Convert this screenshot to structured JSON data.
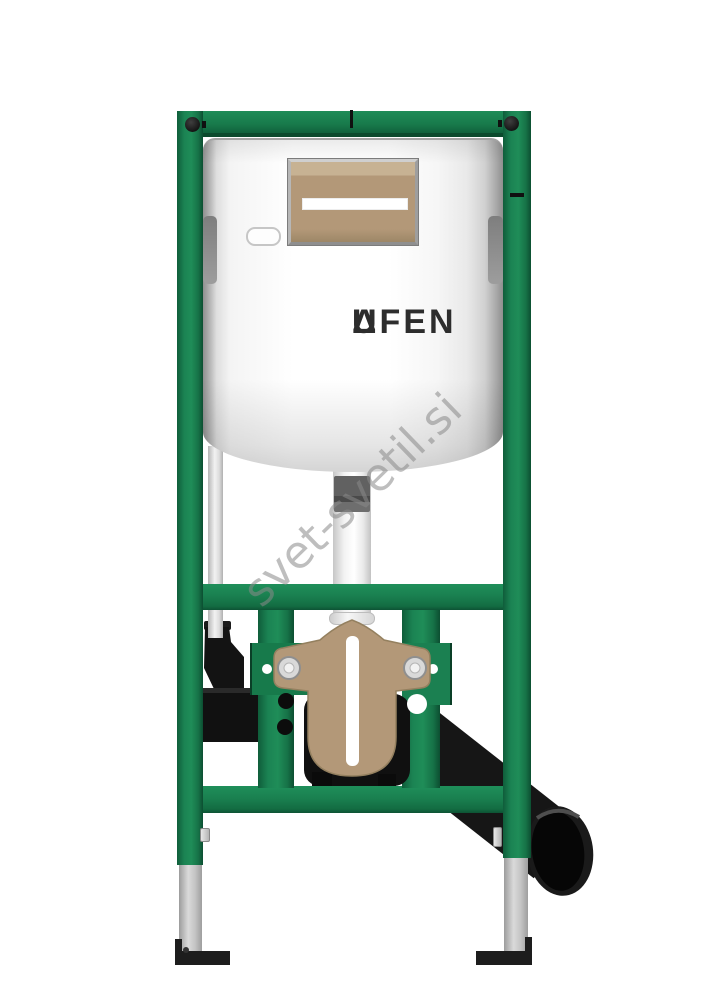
{
  "brand": {
    "prefix": "L",
    "triangle": "Δ",
    "suffix": "UFEN"
  },
  "watermark": {
    "text": "svet-svetil.si"
  },
  "colors": {
    "frame-green": "#187a4c",
    "frame-green-dark": "#0d5434",
    "frame-green-light": "#209059",
    "panel-tan": "#b39878",
    "panel-tan-light": "#c7b293",
    "part-black": "#141414",
    "metal-silver": "#c6c6c6",
    "cistern-white": "#fafafa",
    "logo-dark": "#2d2d2d",
    "watermark-gray": "#8a8a8a"
  }
}
